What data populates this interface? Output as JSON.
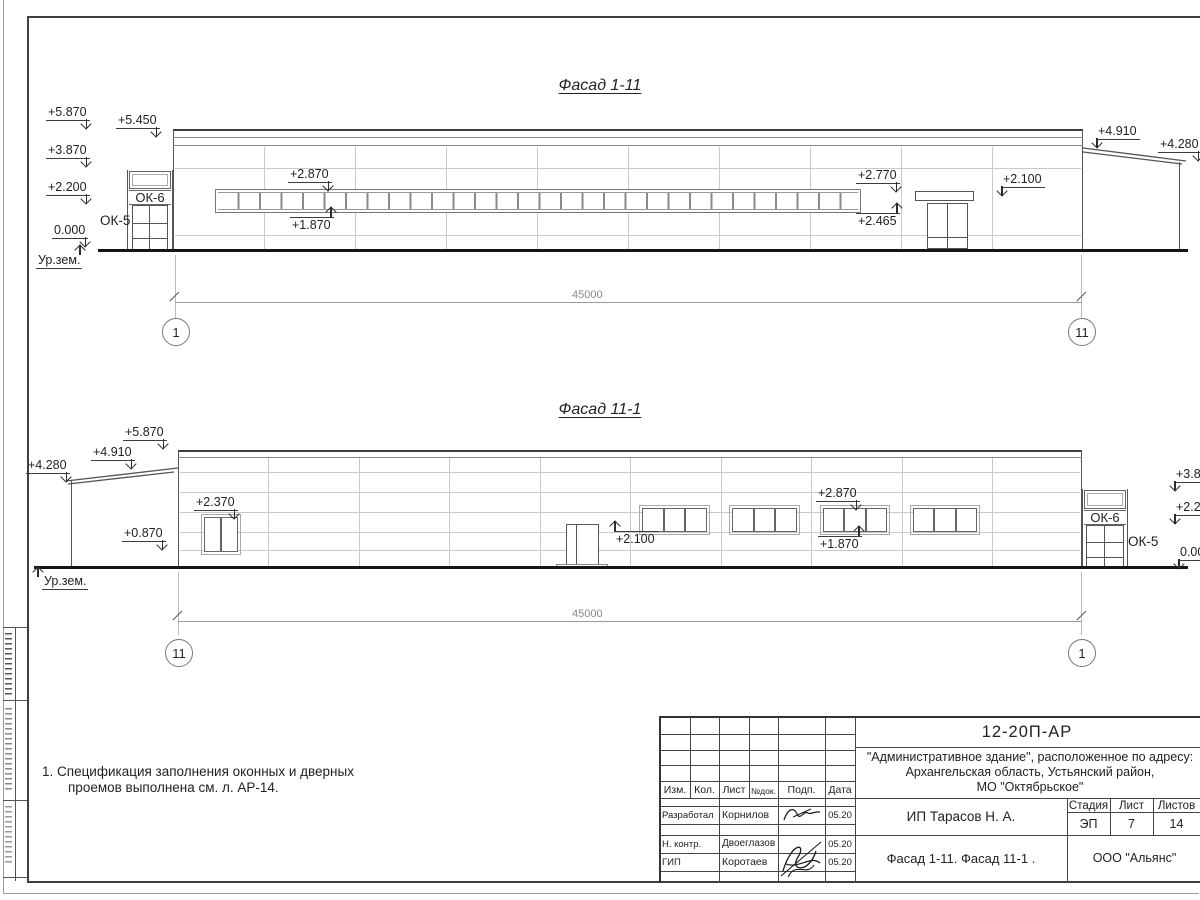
{
  "sheet": {
    "note": {
      "line1": "1. Спецификация заполнения оконных и дверных",
      "line2": "проемов выполнена см. л. АР-14."
    }
  },
  "facade1": {
    "title": "Фасад 1-11",
    "dim_total": "45000",
    "axis_left": "1",
    "axis_right": "11",
    "window_label_top": "ОК-6",
    "window_label_side": "ОК-5",
    "ground_label": "Ур.зем.",
    "marks": {
      "lvl_5870": "+5.870",
      "lvl_3870": "+3.870",
      "lvl_2200": "+2.200",
      "lvl_0000": "0.000",
      "lvl_5450": "+5.450",
      "lvl_2870": "+2.870",
      "lvl_1870": "+1.870",
      "lvl_2770": "+2.770",
      "lvl_2465": "+2.465",
      "lvl_2100": "+2.100",
      "lvl_4910": "+4.910",
      "lvl_4280": "+4.280"
    }
  },
  "facade2": {
    "title": "Фасад 11-1",
    "dim_total": "45000",
    "axis_left": "11",
    "axis_right": "1",
    "window_label_top": "ОК-6",
    "window_label_side": "ОК-5",
    "ground_label": "Ур.зем.",
    "marks": {
      "lvl_4280": "+4.280",
      "lvl_4910": "+4.910",
      "lvl_5870": "+5.870",
      "lvl_2370": "+2.370",
      "lvl_0870": "+0.870",
      "lvl_2100": "+2.100",
      "lvl_2870": "+2.870",
      "lvl_1870": "+1.870",
      "lvl_3870_clipped": "+3.87",
      "lvl_2200_clipped": "+2.20",
      "lvl_0000_clipped": "0.00"
    }
  },
  "titleblock": {
    "code": "12-20П-АР",
    "project_line1": "\"Административное здание\", расположенное по адресу:",
    "project_line2": "Архангельская область, Устьянский район,",
    "project_line3": "МО \"Октябрьское\"",
    "header": {
      "izm": "Изм.",
      "kol": "Кол.",
      "list": "Лист",
      "ndok": "№док.",
      "podp": "Подп.",
      "data": "Дата"
    },
    "rows": [
      {
        "role": "Разработал",
        "name": "Корнилов",
        "date": "05.20"
      },
      {
        "role": "Н. контр.",
        "name": "Двоеглазов",
        "date": "05.20"
      },
      {
        "role": "ГИП",
        "name": "Коротаев",
        "date": "05.20"
      }
    ],
    "client": "ИП Тарасов Н. А.",
    "sheet_title": "Фасад 1-11. Фасад 11-1 .",
    "stage_label": "Стадия",
    "sheet_label": "Лист",
    "sheets_label": "Листов",
    "stage": "ЭП",
    "sheet_no": "7",
    "sheets_total": "14",
    "company": "ООО \"Альянс\""
  }
}
